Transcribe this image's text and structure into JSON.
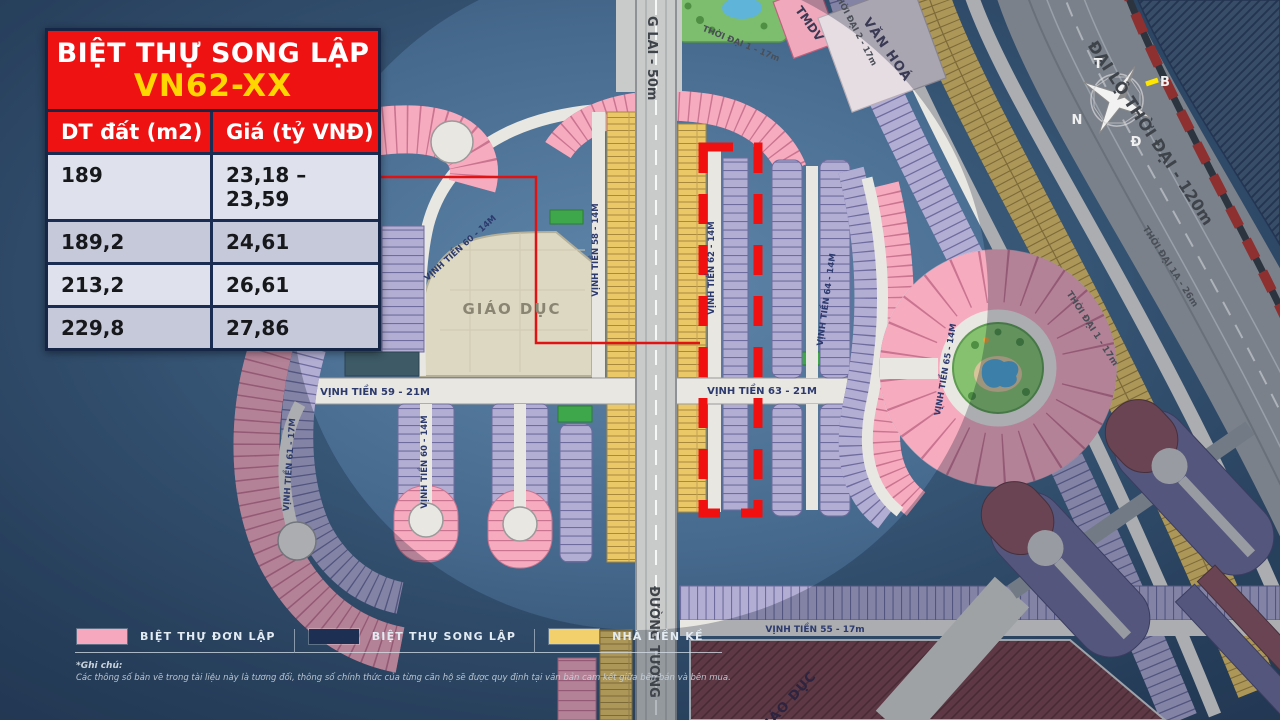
{
  "panel": {
    "title_line1": "BIỆT THỰ SONG LẬP",
    "title_line2": "VN62-XX"
  },
  "table": {
    "col_area": "DT đất (m2)",
    "col_price": "Giá (tỷ VNĐ)",
    "rows": [
      {
        "area": "189",
        "price": "23,18 – 23,59"
      },
      {
        "area": "189,2",
        "price": "24,61"
      },
      {
        "area": "213,2",
        "price": "26,61"
      },
      {
        "area": "229,8",
        "price": "27,86"
      }
    ]
  },
  "legend": {
    "items": [
      {
        "label": "BIỆT THỰ ĐƠN LẬP",
        "color": "#f6a9be"
      },
      {
        "label": "BIỆT THỰ SONG LẬP",
        "color": "#1d3054"
      },
      {
        "label": "NHÀ LIỀN KỀ",
        "color": "#f2d06b"
      }
    ]
  },
  "note": {
    "title": "*Ghi chú:",
    "text": "Các thông số bản vẽ trong tài liệu này là tương đối, thông số chính thức của từng căn hộ sẽ được quy định tại văn bản cam kết giữa bên bán và bên mua."
  },
  "map": {
    "areas": {
      "education": "GIÁO DỤC",
      "education_south": "GIÁO DỤC",
      "culture": "VĂN HOÁ",
      "commercial": "TMDV"
    },
    "roads": {
      "main_avenue": "ĐẠI LỘ THỜI ĐẠI - 120m",
      "future_road_top": "G LAI - 50m",
      "future_road_bottom": "ĐƯỜNG TƯƠNG",
      "thoi_dai_1_top": "THỜI ĐẠI 1 - 17m",
      "thoi_dai_2": "THỜI ĐẠI 2 - 17m",
      "thoi_dai_1": "THỜI ĐẠI 1 - 17m",
      "thoi_dai_1a": "THỜI ĐẠI 1A - 26m",
      "vt55": "VỊNH TIỀN 55 - 17m",
      "vt58": "VỊNH TIỀN 58 - 14M",
      "vt59": "VỊNH TIỀN 59 - 21M",
      "vt60_loop": "VỊNH TIỀN 60 - 14M",
      "vt60": "VỊNH TIỀN 60 - 14M",
      "vt61": "VỊNH TIỀN 61 - 17M",
      "vt62": "VỊNH TIỀN 62 - 14M",
      "vt63": "VỊNH TIỀN 63 - 21M",
      "vt64": "VỊNH TIỀN 64 - 14M",
      "vt65": "VỊNH TIỀN 65 - 14M"
    },
    "compass": {
      "t": "T",
      "b": "B",
      "n": "N",
      "d": "Đ"
    }
  },
  "colors": {
    "villa_single": "#f6a9be",
    "villa_semi": "#1d3054",
    "townhouse": "#f2d06b",
    "highlight_red": "#f01010",
    "water": "#3a5a7c"
  }
}
